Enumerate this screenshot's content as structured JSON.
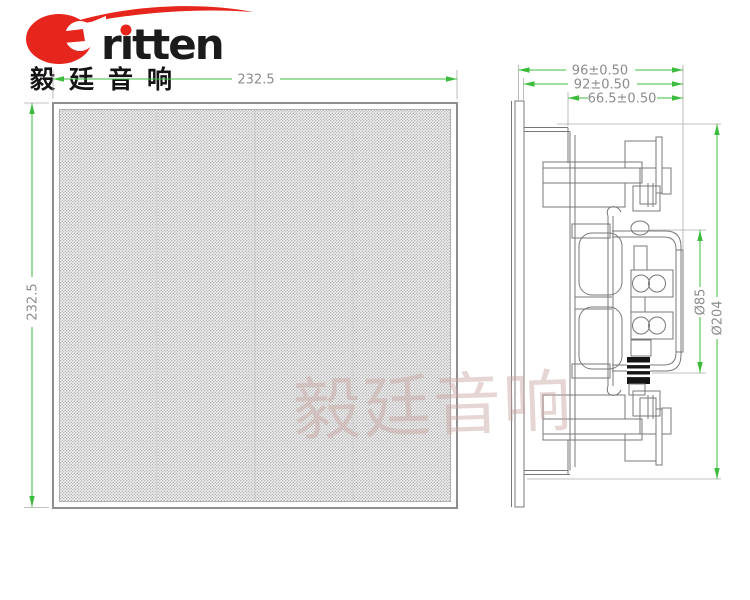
{
  "logo": {
    "text_latin": "rıtten",
    "text_cn": "毅廷音响",
    "red": "#e6261c",
    "black": "#1b1b1b"
  },
  "watermark": {
    "text": "毅廷音响"
  },
  "front_view": {
    "dim_width": "232.5",
    "dim_height": "232.5"
  },
  "side_view": {
    "dim_depth_overall": "96±0.50",
    "dim_depth_behind_flange": "92±0.50",
    "dim_depth_mounting": "66.5±0.50",
    "dim_diameter_magnet": "Ø85",
    "dim_diameter_body": "Ø204"
  },
  "colors": {
    "dimension_green": "#3cbc3c",
    "dimension_text_gray": "#8c8c8c",
    "drawing_line_gray": "#787878",
    "logo_red": "#e6261c",
    "watermark_pink": "#c9a5a0"
  }
}
